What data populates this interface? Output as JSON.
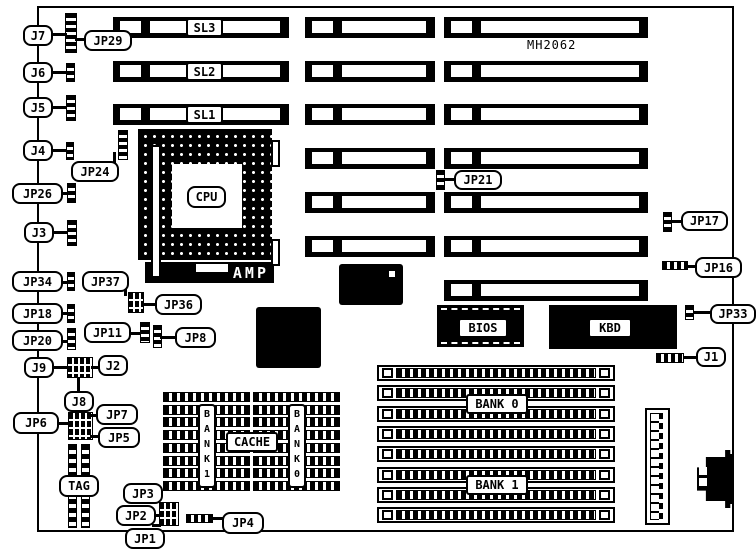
{
  "title": "MH2062",
  "colors": {
    "ink": "#000000",
    "paper": "#ffffff"
  },
  "board": {
    "x": 37,
    "y": 6,
    "w": 697,
    "h": 526
  },
  "slots": {
    "h": 21,
    "label_x": 186,
    "label_w": 37,
    "label_h": 19,
    "columns": [
      {
        "x": 113,
        "w": 176,
        "rows": [
          17,
          61,
          104
        ],
        "labels": [
          "SL3",
          "SL2",
          "SL1"
        ]
      },
      {
        "x": 305,
        "w": 130,
        "rows": [
          17,
          61,
          104,
          148,
          192,
          236
        ]
      },
      {
        "x": 444,
        "w": 204,
        "rows": [
          17,
          61,
          104,
          148,
          192,
          236,
          280
        ]
      }
    ]
  },
  "cpu": {
    "label": "CPU",
    "socket": {
      "x": 138,
      "y": 129,
      "w": 134,
      "h": 131
    },
    "die": {
      "x": 172,
      "y": 164,
      "w": 70,
      "h": 64
    },
    "label_box": {
      "x": 187,
      "y": 186,
      "w": 39,
      "h": 22
    },
    "lever": {
      "x": 151,
      "y": 145,
      "w": 10,
      "h": 133
    },
    "tabs": [
      {
        "x": 271,
        "y": 140,
        "w": 9,
        "h": 27
      },
      {
        "x": 271,
        "y": 239,
        "w": 9,
        "h": 27
      }
    ],
    "amp_label": "AMP",
    "amp_bar": {
      "x": 145,
      "y": 262,
      "w": 129,
      "h": 21
    },
    "amp_window": {
      "x": 51,
      "y": 2,
      "w": 32,
      "h": 8
    }
  },
  "labels": [
    {
      "text": "J7",
      "x": 23,
      "y": 25,
      "w": 30,
      "h": 21
    },
    {
      "text": "JP29",
      "x": 84,
      "y": 30,
      "w": 48,
      "h": 21
    },
    {
      "text": "J6",
      "x": 23,
      "y": 62,
      "w": 30,
      "h": 21
    },
    {
      "text": "J5",
      "x": 23,
      "y": 97,
      "w": 30,
      "h": 21
    },
    {
      "text": "J4",
      "x": 23,
      "y": 140,
      "w": 30,
      "h": 21
    },
    {
      "text": "JP24",
      "x": 71,
      "y": 161,
      "w": 48,
      "h": 21
    },
    {
      "text": "JP26",
      "x": 12,
      "y": 183,
      "w": 51,
      "h": 21
    },
    {
      "text": "J3",
      "x": 24,
      "y": 222,
      "w": 30,
      "h": 21
    },
    {
      "text": "JP34",
      "x": 12,
      "y": 271,
      "w": 51,
      "h": 21
    },
    {
      "text": "JP37",
      "x": 82,
      "y": 271,
      "w": 47,
      "h": 21
    },
    {
      "text": "JP36",
      "x": 155,
      "y": 294,
      "w": 47,
      "h": 21
    },
    {
      "text": "JP18",
      "x": 12,
      "y": 303,
      "w": 51,
      "h": 21
    },
    {
      "text": "JP11",
      "x": 84,
      "y": 322,
      "w": 47,
      "h": 21
    },
    {
      "text": "JP8",
      "x": 175,
      "y": 327,
      "w": 41,
      "h": 21
    },
    {
      "text": "JP20",
      "x": 12,
      "y": 330,
      "w": 51,
      "h": 21
    },
    {
      "text": "J9",
      "x": 24,
      "y": 357,
      "w": 30,
      "h": 21
    },
    {
      "text": "J2",
      "x": 98,
      "y": 355,
      "w": 30,
      "h": 21
    },
    {
      "text": "J8",
      "x": 64,
      "y": 391,
      "w": 30,
      "h": 21
    },
    {
      "text": "JP6",
      "x": 13,
      "y": 412,
      "w": 46,
      "h": 22
    },
    {
      "text": "JP7",
      "x": 96,
      "y": 404,
      "w": 42,
      "h": 21
    },
    {
      "text": "JP5",
      "x": 98,
      "y": 427,
      "w": 42,
      "h": 21
    },
    {
      "text": "TAG",
      "x": 59,
      "y": 475,
      "w": 40,
      "h": 22
    },
    {
      "text": "JP3",
      "x": 123,
      "y": 483,
      "w": 40,
      "h": 21
    },
    {
      "text": "JP2",
      "x": 116,
      "y": 505,
      "w": 40,
      "h": 21
    },
    {
      "text": "JP1",
      "x": 125,
      "y": 528,
      "w": 40,
      "h": 21
    },
    {
      "text": "JP4",
      "x": 222,
      "y": 512,
      "w": 42,
      "h": 22
    },
    {
      "text": "JP21",
      "x": 454,
      "y": 170,
      "w": 48,
      "h": 20
    },
    {
      "text": "JP17",
      "x": 681,
      "y": 211,
      "w": 47,
      "h": 20
    },
    {
      "text": "JP16",
      "x": 695,
      "y": 257,
      "w": 47,
      "h": 21
    },
    {
      "text": "JP33",
      "x": 710,
      "y": 304,
      "w": 46,
      "h": 20
    },
    {
      "text": "J1",
      "x": 696,
      "y": 347,
      "w": 30,
      "h": 20
    },
    {
      "text": "BIOS",
      "x": 458,
      "y": 318,
      "w": 50,
      "h": 20,
      "sq": true
    },
    {
      "text": "KBD",
      "x": 588,
      "y": 318,
      "w": 44,
      "h": 20,
      "sq": true
    },
    {
      "text": "CACHE",
      "x": 226,
      "y": 432,
      "w": 52,
      "h": 20,
      "sq": true
    },
    {
      "text": "BANK 0",
      "x": 466,
      "y": 394,
      "w": 62,
      "h": 20,
      "sq": true
    },
    {
      "text": "BANK 1",
      "x": 466,
      "y": 475,
      "w": 62,
      "h": 20,
      "sq": true
    }
  ],
  "vertical_labels": [
    {
      "text": "BANK1",
      "x": 198,
      "y": 404,
      "w": 18,
      "h": 84
    },
    {
      "text": "BANK0",
      "x": 288,
      "y": 404,
      "w": 18,
      "h": 84
    }
  ],
  "jumpers": [
    {
      "name": "j7-jp29-jumper",
      "x": 65,
      "y": 13,
      "w": 12,
      "h": 40,
      "o": "v"
    },
    {
      "name": "j6-jumper",
      "x": 66,
      "y": 63,
      "w": 9,
      "h": 19,
      "o": "v"
    },
    {
      "name": "j5-jumper",
      "x": 66,
      "y": 95,
      "w": 10,
      "h": 26,
      "o": "v"
    },
    {
      "name": "j4-jumper",
      "x": 66,
      "y": 142,
      "w": 8,
      "h": 18,
      "o": "v"
    },
    {
      "name": "jp24-jumper",
      "x": 118,
      "y": 130,
      "w": 10,
      "h": 30,
      "o": "v"
    },
    {
      "name": "jp26-jumper",
      "x": 67,
      "y": 183,
      "w": 9,
      "h": 20,
      "o": "v"
    },
    {
      "name": "j3-jumper",
      "x": 67,
      "y": 220,
      "w": 10,
      "h": 26,
      "o": "v"
    },
    {
      "name": "jp34-jumper",
      "x": 67,
      "y": 272,
      "w": 8,
      "h": 19,
      "o": "v"
    },
    {
      "name": "jp36-jp37-jumper",
      "x": 128,
      "y": 292,
      "w": 16,
      "h": 21,
      "o": "b"
    },
    {
      "name": "jp18-jumper",
      "x": 67,
      "y": 304,
      "w": 8,
      "h": 19,
      "o": "v"
    },
    {
      "name": "jp11-jumper",
      "x": 140,
      "y": 322,
      "w": 10,
      "h": 21,
      "o": "v"
    },
    {
      "name": "jp8-jumper",
      "x": 153,
      "y": 325,
      "w": 9,
      "h": 23,
      "o": "v"
    },
    {
      "name": "jp20-jumper",
      "x": 67,
      "y": 328,
      "w": 9,
      "h": 22,
      "o": "v"
    },
    {
      "name": "j9-j2-jumper",
      "x": 67,
      "y": 357,
      "w": 26,
      "h": 21,
      "o": "b"
    },
    {
      "name": "jp6-jp7-jp5-jumper",
      "x": 68,
      "y": 412,
      "w": 25,
      "h": 28,
      "o": "b"
    },
    {
      "name": "jp1-jp2-jp3-jumper",
      "x": 159,
      "y": 502,
      "w": 20,
      "h": 24,
      "o": "b"
    },
    {
      "name": "jp4-jumper",
      "x": 186,
      "y": 514,
      "w": 27,
      "h": 9,
      "o": "h"
    },
    {
      "name": "jp21-jumper",
      "x": 436,
      "y": 170,
      "w": 9,
      "h": 20,
      "o": "v"
    },
    {
      "name": "jp17-jumper",
      "x": 663,
      "y": 212,
      "w": 9,
      "h": 20,
      "o": "v"
    },
    {
      "name": "jp16-jumper",
      "x": 662,
      "y": 261,
      "w": 26,
      "h": 9,
      "o": "h"
    },
    {
      "name": "jp33-jumper",
      "x": 685,
      "y": 305,
      "w": 9,
      "h": 15,
      "o": "v"
    },
    {
      "name": "j1-jumper",
      "x": 656,
      "y": 353,
      "w": 28,
      "h": 10,
      "o": "h"
    }
  ],
  "leader_lines": [
    {
      "name": "leader-j7",
      "x": 51,
      "y": 33,
      "w": 16,
      "h": 3
    },
    {
      "name": "leader-jp29",
      "x": 75,
      "y": 38,
      "w": 11,
      "h": 3
    },
    {
      "name": "leader-j6",
      "x": 51,
      "y": 71,
      "w": 16,
      "h": 3
    },
    {
      "name": "leader-j5",
      "x": 51,
      "y": 106,
      "w": 16,
      "h": 3
    },
    {
      "name": "leader-j4",
      "x": 51,
      "y": 149,
      "w": 16,
      "h": 3
    },
    {
      "name": "leader-jp24",
      "x": 113,
      "y": 152,
      "w": 3,
      "h": 11
    },
    {
      "name": "leader-jp26",
      "x": 51,
      "y": 192,
      "w": 17,
      "h": 3
    },
    {
      "name": "leader-j3",
      "x": 52,
      "y": 231,
      "w": 16,
      "h": 3
    },
    {
      "name": "leader-jp34",
      "x": 52,
      "y": 281,
      "w": 16,
      "h": 3
    },
    {
      "name": "leader-jp37",
      "x": 124,
      "y": 288,
      "w": 3,
      "h": 8
    },
    {
      "name": "leader-jp36",
      "x": 142,
      "y": 303,
      "w": 15,
      "h": 3
    },
    {
      "name": "leader-jp18",
      "x": 52,
      "y": 312,
      "w": 16,
      "h": 3
    },
    {
      "name": "leader-jp11",
      "x": 129,
      "y": 332,
      "w": 12,
      "h": 3
    },
    {
      "name": "leader-jp8",
      "x": 160,
      "y": 336,
      "w": 16,
      "h": 3
    },
    {
      "name": "leader-jp20",
      "x": 52,
      "y": 340,
      "w": 16,
      "h": 3
    },
    {
      "name": "leader-j9",
      "x": 52,
      "y": 366,
      "w": 16,
      "h": 3
    },
    {
      "name": "leader-j2",
      "x": 91,
      "y": 366,
      "w": 9,
      "h": 3
    },
    {
      "name": "leader-j8",
      "x": 77,
      "y": 377,
      "w": 3,
      "h": 15
    },
    {
      "name": "leader-jp6",
      "x": 57,
      "y": 422,
      "w": 12,
      "h": 3
    },
    {
      "name": "leader-jp7",
      "x": 90,
      "y": 414,
      "w": 8,
      "h": 3
    },
    {
      "name": "leader-jp5",
      "x": 90,
      "y": 435,
      "w": 9,
      "h": 3
    },
    {
      "name": "leader-jp3",
      "x": 151,
      "y": 498,
      "w": 10,
      "h": 3
    },
    {
      "name": "leader-jp2",
      "x": 150,
      "y": 514,
      "w": 10,
      "h": 3
    },
    {
      "name": "leader-jp1",
      "x": 152,
      "y": 524,
      "w": 9,
      "h": 3
    },
    {
      "name": "leader-jp4",
      "x": 210,
      "y": 517,
      "w": 13,
      "h": 3
    },
    {
      "name": "leader-jp21",
      "x": 444,
      "y": 178,
      "w": 11,
      "h": 3
    },
    {
      "name": "leader-jp17",
      "x": 671,
      "y": 220,
      "w": 11,
      "h": 3
    },
    {
      "name": "leader-jp16",
      "x": 687,
      "y": 265,
      "w": 9,
      "h": 3
    },
    {
      "name": "leader-jp33",
      "x": 693,
      "y": 311,
      "w": 18,
      "h": 3
    },
    {
      "name": "leader-j1",
      "x": 683,
      "y": 356,
      "w": 14,
      "h": 3
    }
  ],
  "chips": {
    "qfp": [
      {
        "name": "qfp-chip-1",
        "x": 339,
        "y": 264,
        "w": 64,
        "h": 41,
        "dot": true
      },
      {
        "name": "qfp-chip-2",
        "x": 256,
        "y": 307,
        "w": 65,
        "h": 61
      }
    ],
    "rom": [
      {
        "name": "bios-chip",
        "x": 437,
        "y": 305,
        "w": 87,
        "h": 42,
        "dashed": true
      },
      {
        "name": "kbd-chip",
        "x": 549,
        "y": 305,
        "w": 128,
        "h": 44
      }
    ]
  },
  "simm": {
    "x": 377,
    "w": 238,
    "h": 16,
    "rows": [
      365,
      385,
      406,
      426,
      446,
      467,
      487,
      507
    ]
  },
  "cache": {
    "groups": [
      {
        "x": 163,
        "y": 392,
        "w": 87,
        "rows": 8,
        "pitch": 12.7,
        "h": 10
      },
      {
        "x": 253,
        "y": 392,
        "w": 87,
        "rows": 8,
        "pitch": 12.7,
        "h": 10
      }
    ]
  },
  "tag": {
    "cols": [
      {
        "x": 68,
        "y": 444,
        "w": 9,
        "h": 84
      },
      {
        "x": 81,
        "y": 444,
        "w": 9,
        "h": 84
      }
    ]
  },
  "power": {
    "x": 645,
    "y": 408,
    "w": 25,
    "h": 117
  },
  "din": {
    "x": 697,
    "y": 450,
    "w": 37,
    "h": 58,
    "notches": [
      {
        "x": 699,
        "y": 467,
        "w": 8,
        "h": 8
      },
      {
        "x": 699,
        "y": 478,
        "w": 8,
        "h": 8
      }
    ]
  }
}
